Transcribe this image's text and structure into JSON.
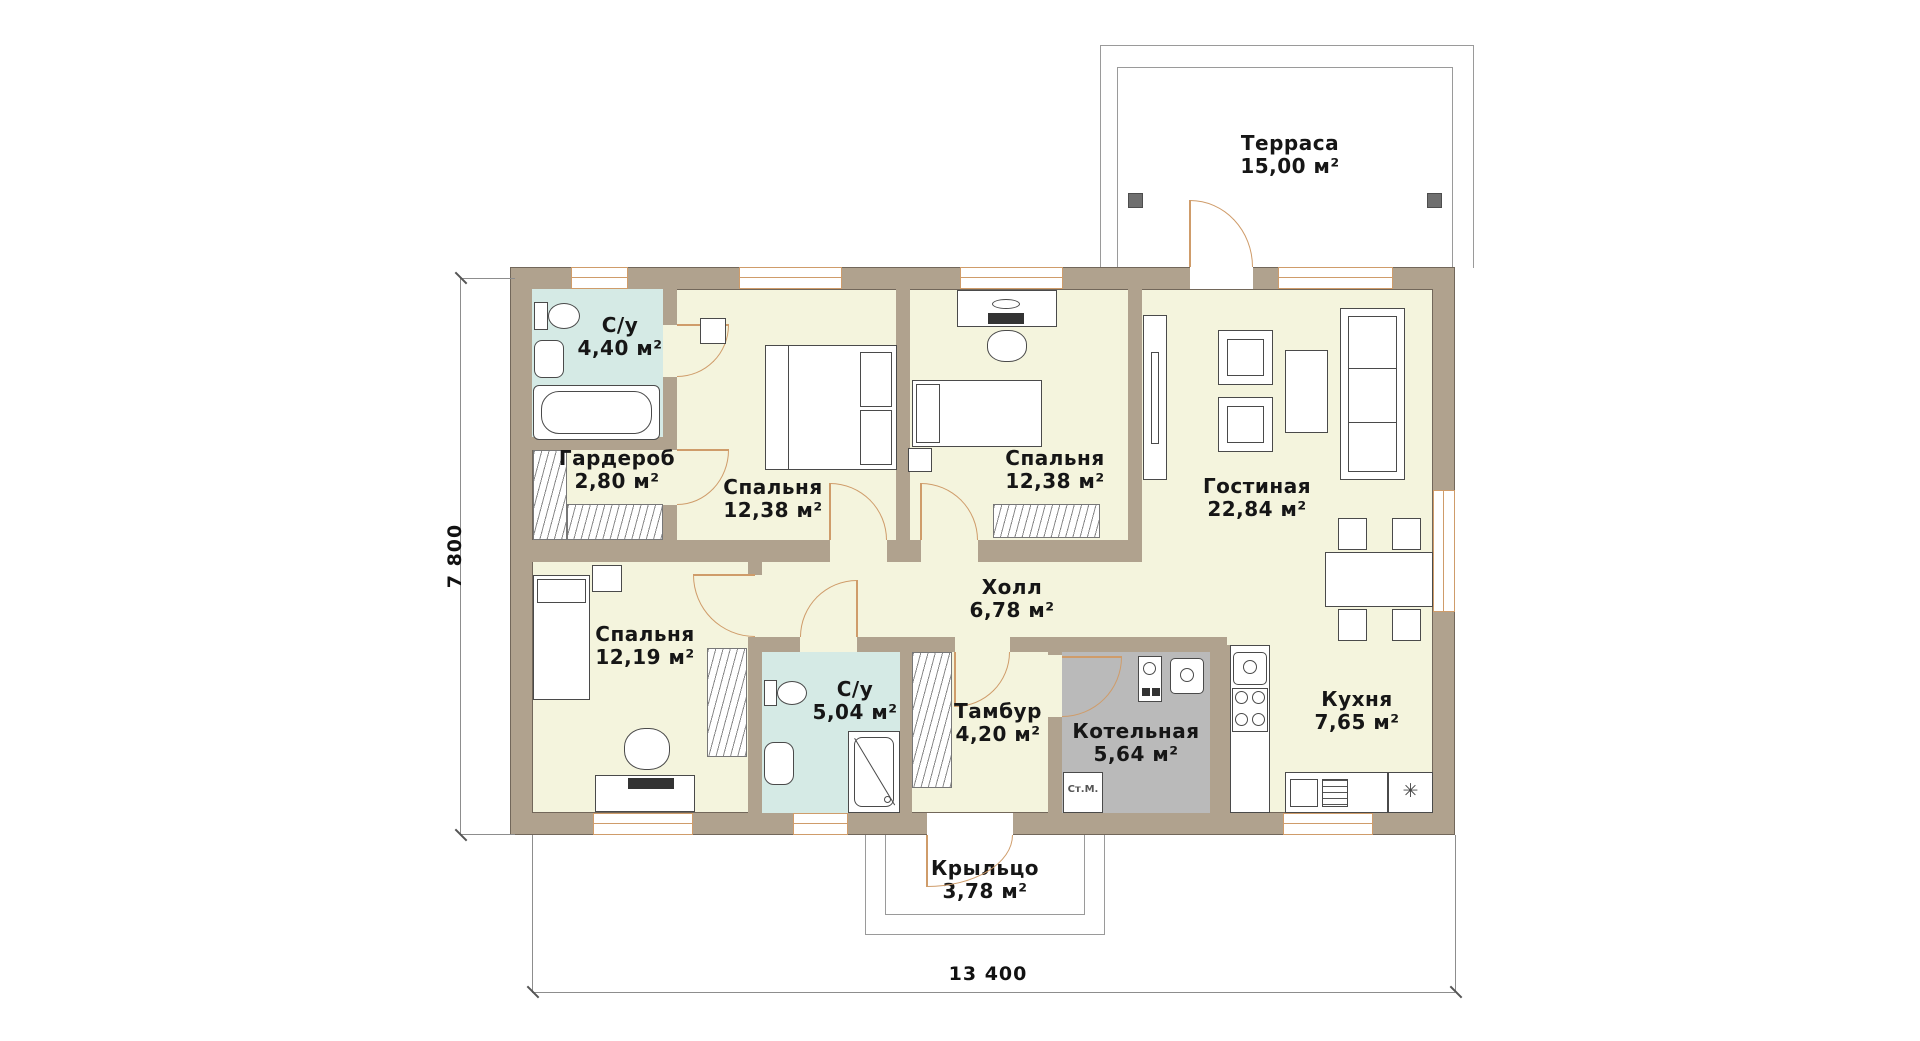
{
  "rooms": {
    "terrace": {
      "name": "Терраса",
      "area": "15,00 м²"
    },
    "bath_master": {
      "name": "С/у",
      "area": "4,40 м²"
    },
    "wardrobe": {
      "name": "Гардероб",
      "area": "2,80 м²"
    },
    "bedroom1": {
      "name": "Спальня",
      "area": "12,38 м²"
    },
    "bedroom2": {
      "name": "Спальня",
      "area": "12,38 м²"
    },
    "living": {
      "name": "Гостиная",
      "area": "22,84 м²"
    },
    "hall": {
      "name": "Холл",
      "area": "6,78 м²"
    },
    "bedroom3": {
      "name": "Спальня",
      "area": "12,19 м²"
    },
    "bath2": {
      "name": "С/у",
      "area": "5,04 м²"
    },
    "vestibule": {
      "name": "Тамбур",
      "area": "4,20 м²"
    },
    "boiler": {
      "name": "Котельная",
      "area": "5,64 м²"
    },
    "kitchen": {
      "name": "Кухня",
      "area": "7,65 м²"
    },
    "porch": {
      "name": "Крыльцо",
      "area": "3,78 м²"
    }
  },
  "dimensions": {
    "overall_width": "13 400",
    "overall_height": "7 800"
  },
  "fixtures": {
    "washer_label": "Ст.М.",
    "fridge_glyph": "✳"
  },
  "colors": {
    "wall": "#b0a28e",
    "floor": "#f4f4dd",
    "wet_room": "#d5eae5",
    "boiler_room": "#bababa",
    "accent": "#cf9c6a"
  }
}
